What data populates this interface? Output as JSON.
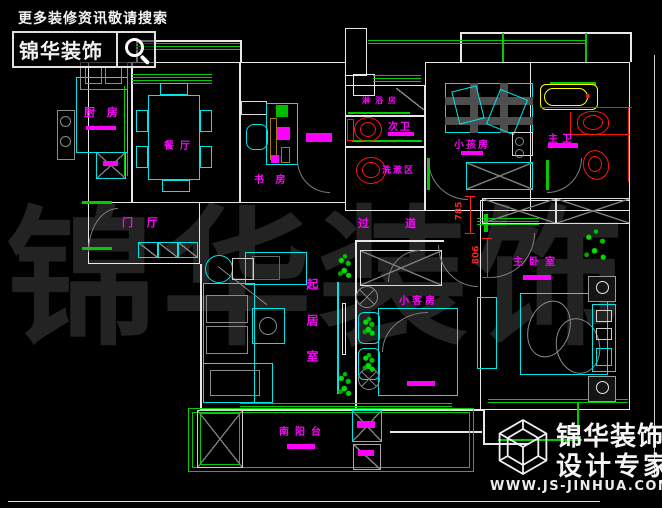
{
  "header": {
    "notice": "更多装修资讯敬请搜索",
    "brand": "锦华装饰",
    "search_icon": "magnifier"
  },
  "watermark": "锦华装饰",
  "rooms": [
    {
      "id": "kitchen",
      "label": "厨 房"
    },
    {
      "id": "dining",
      "label": "餐厅"
    },
    {
      "id": "study",
      "label": "书 房"
    },
    {
      "id": "shower",
      "label": "淋浴房"
    },
    {
      "id": "bath2",
      "label": "次卫"
    },
    {
      "id": "washarea",
      "label": "洗漱区"
    },
    {
      "id": "kidsroom",
      "label": "小孩房"
    },
    {
      "id": "masterbath",
      "label": "主卫"
    },
    {
      "id": "foyer",
      "label": "门 厅"
    },
    {
      "id": "corridor",
      "label": "过道"
    },
    {
      "id": "living",
      "label": "起居室"
    },
    {
      "id": "guestroom",
      "label": "小客房"
    },
    {
      "id": "masterbedroom",
      "label": "主卧室"
    },
    {
      "id": "balcony",
      "label": "南阳台"
    }
  ],
  "dims": [
    "785",
    "806"
  ],
  "logo": {
    "brand": "锦华装饰",
    "tagline": "设计专家",
    "website": "WWW.JS-JINHUA.COM",
    "icon": "isometric-cube"
  },
  "colors": {
    "wall": "#e8e8e8",
    "window": "#00cc00",
    "furniture": "#00e5e5",
    "label": "#ff00ff",
    "fixture": "#ff1414",
    "bathtub": "#ffff00",
    "dimension": "#ff2020",
    "watermark": "#232323"
  }
}
